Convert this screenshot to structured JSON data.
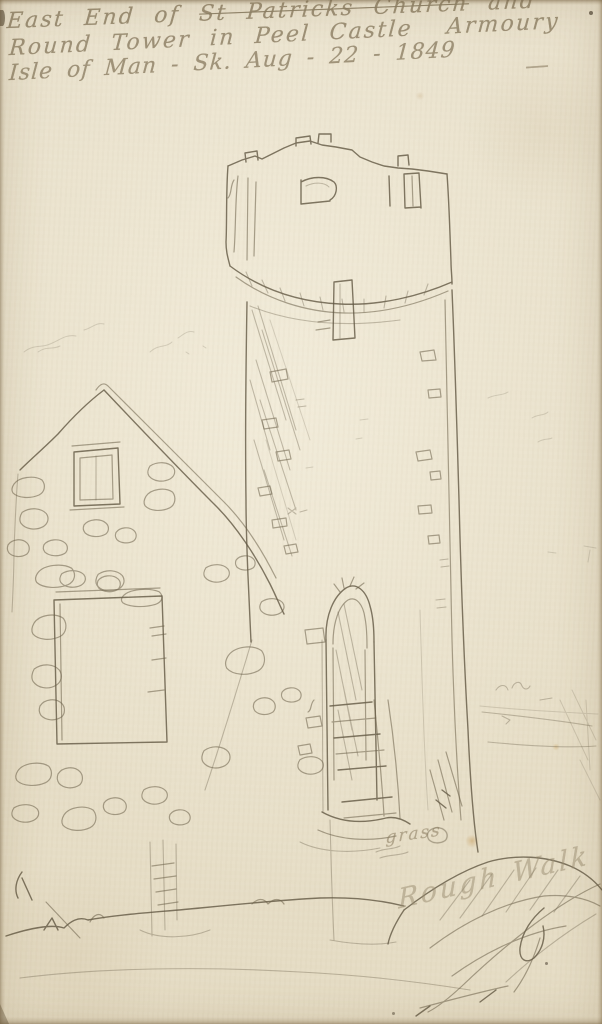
{
  "inscription": {
    "line1_start": "East End of ",
    "line1_struck": "St Patricks Church",
    "line1_end": " and",
    "line2_main": "Round Tower in Peel Castle",
    "line2_right": "Armoury",
    "line2_dash": "—",
    "line3": "Isle of Man - Sk. Aug - 22 - 1849"
  },
  "annotations": {
    "grass_label": "grass",
    "bottom_right_word1": "Rough",
    "bottom_right_word2": "Walk"
  },
  "colors": {
    "paper": "#e9e1cc",
    "paper_edge": "#d8cdb3",
    "pencil_dark": "#5f5540",
    "pencil_mid": "#6b6049",
    "pencil_faint": "#6f6550",
    "handwriting": "#8b7d62",
    "ink_blot": "#3f3724"
  }
}
